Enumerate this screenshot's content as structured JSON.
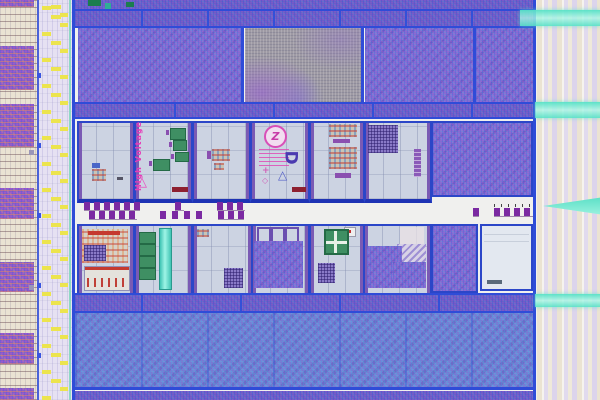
{
  "scene": {
    "type": "integrated-circuit die photograph",
    "description": "Optical microscope photo of a CMOS test-chip die: purple standard-cell logic blocks, a gray SRAM-like array, two rows of light analog/high-voltage test tiles with probe pads, yellow-marked I/O pad strips on the left and a striped power-routing strip with cyan bands on the right",
    "marks": {
      "high_voltage_label": "High Voltage",
      "logo_glyph": "Z",
      "rotated_letter": "D",
      "delta_mark": "△",
      "warning_triangle": "△",
      "cross_mark": "+",
      "diamond_mark": "◇"
    },
    "colors": {
      "logic_purple": "#7e6fd0",
      "logic_blue": "#7282d2",
      "memory_gray": "#9e9aa4",
      "border_blue": "#2f4cd8",
      "tile_background": "#ccd3e2",
      "highlight_cyan": "#58dfc5",
      "pad_yellow": "#ece44e",
      "probe_pad_purple": "#7b2aa2",
      "test_green": "#3f8f63",
      "magenta_text": "#e63cb8",
      "red_structure": "#c53a30",
      "pad_strip_cream": "#eae3d3",
      "pad_strip_lavender": "#e6e1f2"
    }
  }
}
